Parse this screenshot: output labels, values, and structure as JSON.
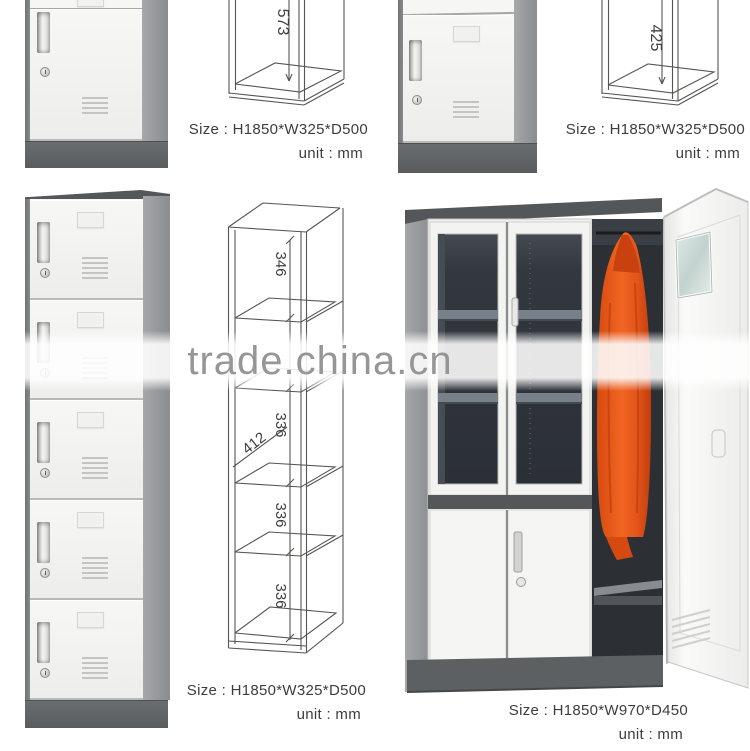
{
  "watermark_text": "trade.china.cn",
  "captions": {
    "top_middle": {
      "size": "Size : H1850*W325*D500",
      "unit": "unit : mm"
    },
    "top_right": {
      "size": "Size : H1850*W325*D500",
      "unit": "unit : mm"
    },
    "bottom_left": {
      "size": "Size : H1850*W325*D500",
      "unit": "unit : mm"
    },
    "bottom_right": {
      "size": "Size : H1850*W970*D450",
      "unit": "unit : mm"
    }
  },
  "diagram_labels": {
    "top_middle_height": "573",
    "top_right_height": "425",
    "bottom_left_c1": "346",
    "bottom_left_c2": "336",
    "bottom_left_diag": "412",
    "bottom_left_c3": "336",
    "bottom_left_c4": "336"
  },
  "colors": {
    "door_white": "#f3f3f1",
    "frame_gray": "#7a7d7f",
    "side_gray": "#9a9c9e",
    "base_gray": "#5e6163",
    "interior_dark": "#2c3035",
    "shelf_gray": "#7a828c",
    "coat_orange": "#e2541a",
    "drawing_line": "#555553",
    "caption_text": "#3d3d3d",
    "watermark_gray": "#969696"
  }
}
